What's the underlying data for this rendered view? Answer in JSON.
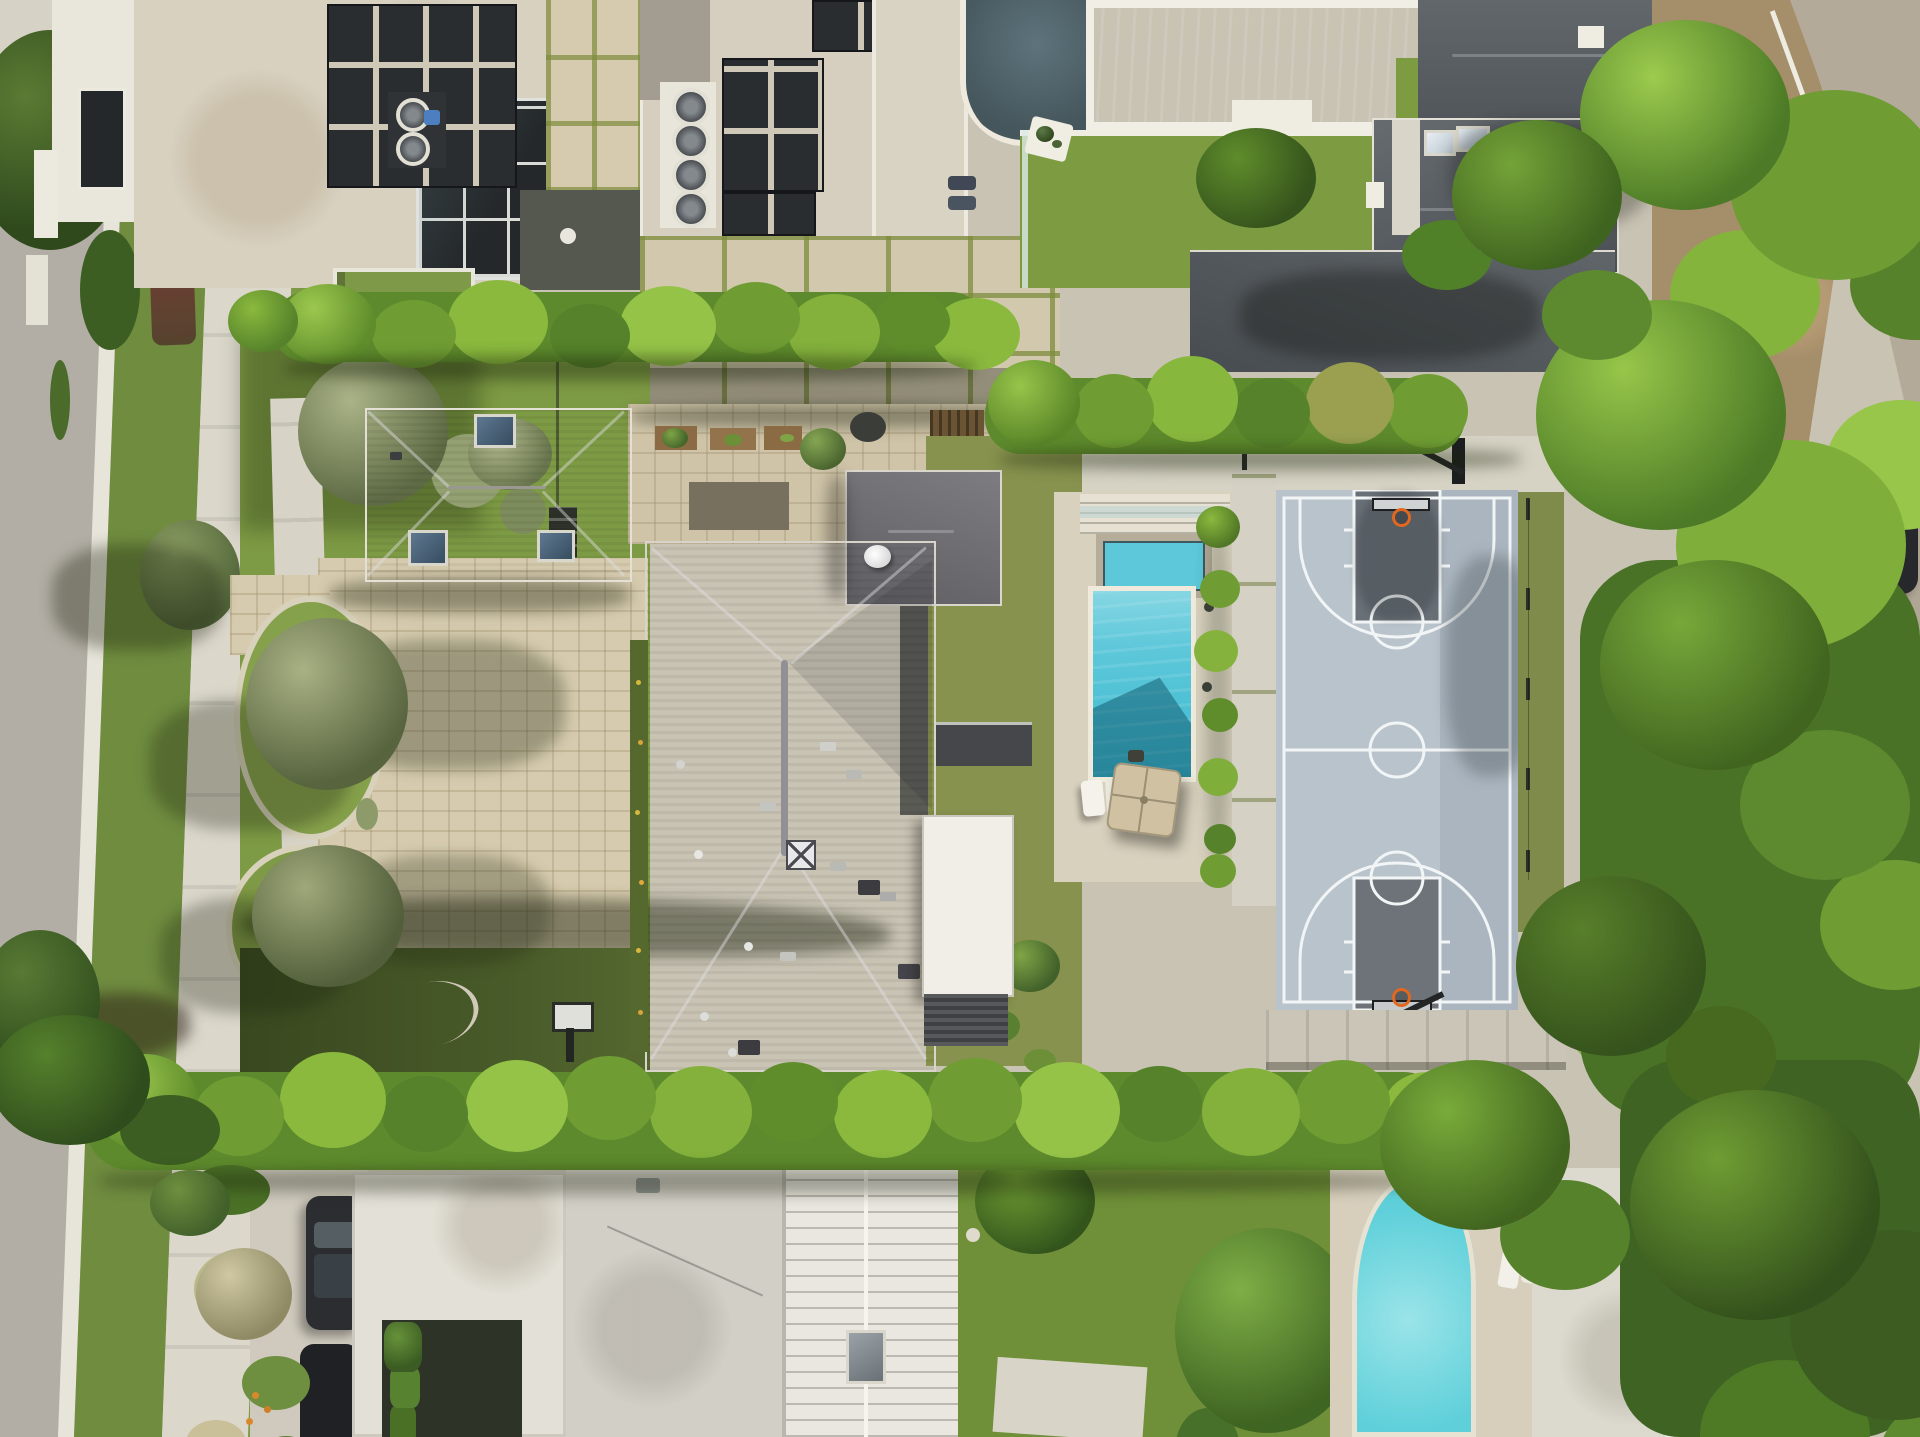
{
  "scene": {
    "title": "Aerial Drone View — Luxury Residential Estate",
    "type": "aerial-drone-photograph",
    "time_of_day": "midday, sunny",
    "description": "Top-down aerial photograph of a luxury residential estate: a large gray hip-roof main house and matching garage around a tan paver motor court, a rectangular turquoise pool with inset spa, artificial-turf backyard with tan patio umbrella and white loungers, a blue-gray basketball court with two hoops and dark painted keys, a small putting green, tall perimeter hedges, a tree-lined street on the west, a rural road on the east, and neighboring modern homes with rooftop solar panels, HVAC fans, turf lawns and two additional swimming pools."
  },
  "palette": {
    "ground": "#c9c3b4",
    "asphalt": "#b3aea5",
    "asphalt_east": "#b4aa99",
    "concrete": "#d8d4c7",
    "concrete_bright": "#e9e5d8",
    "paver_tan": "#d6cbae",
    "patio_paver": "#d2c8ae",
    "lawn": "#7d9a44",
    "turf_back": "#87924e",
    "turf_neighbor": "#7d9c42",
    "putting_green": "#aecb6a",
    "hedge_mid": "#5d8a2c",
    "hedge_light": "#8cbb40",
    "hedge_dark": "#49711f",
    "tree_dark": "#3c5e22",
    "olive_tree": "#a9b184",
    "roof_main": "#716f74",
    "roof_garage": "#7b7774",
    "roof_metal": "#5a6065",
    "roof_cream": "#d8d1c0",
    "roof_white": "#efede4",
    "pool_water": "#4cc0d4",
    "pool_light": "#8ad8e3",
    "pool_shadow": "rgba(16,86,105,0.5)",
    "pool_neighbor": "#4cc5d7",
    "pool_southeast": "#5fd0da",
    "court_surface": "#b9c3cc",
    "court_dark_band": "#aab5bf",
    "court_key": "#697077",
    "court_line": "#f2f5f5",
    "hoop_rim_orange": "#e2671f",
    "glass_dark": "#24282b",
    "solar": "#2a2d30",
    "dirt": "#a58e6a",
    "car_dark": "#26282c",
    "umbrella_tan": "#cfc1a2",
    "wood_slat": "#6b5434",
    "spa_stone": "#b5ac99",
    "cast_shadow": "rgba(28,34,14,0.38)"
  },
  "features": [
    {
      "name": "main-residence-roof",
      "note": "large dark-gray shingle hip roof with satellite dish and vents, center of frame"
    },
    {
      "name": "garage-roof",
      "note": "gray hip roof with three blue skylights, northwest of main house"
    },
    {
      "name": "motor-court",
      "note": "tan stone paver driveway with curved garden beds of olive trees"
    },
    {
      "name": "front-walkway",
      "note": "concrete entry walk and dark metal gates along west fence"
    },
    {
      "name": "estate-pool",
      "note": "rectangular turquoise pool with stone-trimmed spa at its north end and glass fence"
    },
    {
      "name": "pool-umbrella",
      "note": "square tan cantilever umbrella with two white loungers"
    },
    {
      "name": "basketball-court",
      "note": "full court, light blue-gray surface, white lines, dark gray keys, two black hoops"
    },
    {
      "name": "putting-green",
      "note": "small bright green oval south-east of the court"
    },
    {
      "name": "backyard-turf",
      "note": "olive artificial turf between house and pool, white louvered patio roof"
    },
    {
      "name": "outdoor-kitchen",
      "note": "dark BBQ counter and wood slat wall in rear courtyard"
    },
    {
      "name": "perimeter-hedges",
      "note": "tall trimmed hedges on north and south property lines"
    },
    {
      "name": "west-street",
      "note": "asphalt street, white curb, grass parkway, concrete sidewalk, street trees"
    },
    {
      "name": "east-road",
      "note": "rural road with dirt shoulder, parked dark cars, dense tree row"
    },
    {
      "name": "north-neighbor-modern-home",
      "note": "flat cream roofs, black glass curtain wall, solar arrays, HVAC fans, rooftop turf deck"
    },
    {
      "name": "north-neighbor-pool",
      "note": "long turquoise pool with white coping, step notch and turf lawn"
    },
    {
      "name": "north-neighbor-spa",
      "note": "dark mottled water feature beside terrace"
    },
    {
      "name": "northeast-neighbor-roof",
      "note": "charcoal standing-seam metal hip roofs with skylights"
    },
    {
      "name": "south-neighbor-flat-roofs",
      "note": "white flat roof with hedge courtyard, gray flat roof, white ribbed metal roof with skylight"
    },
    {
      "name": "south-neighbor-yard",
      "note": "lawn with circular pavers, palm and banana plants"
    },
    {
      "name": "southeast-neighbor-pool",
      "note": "free-form turquoise pool with loungers, gravel-roof pool house and white fence"
    },
    {
      "name": "driveway-cars",
      "note": "two dark sedans parked on south-west neighbor driveway"
    },
    {
      "name": "wall-basketball-hoop",
      "note": "extra hoop on rear lawn strip against south wall"
    }
  ],
  "counts": {
    "visible_pools": 3,
    "spas_water_features": 2,
    "basketball_hoops": 3,
    "parked_cars": 4,
    "patio_umbrellas": 1,
    "rooftop_fan_units": 6,
    "solar_panel_arrays": 4,
    "garage_skylights": 3,
    "putting_greens": 1
  }
}
